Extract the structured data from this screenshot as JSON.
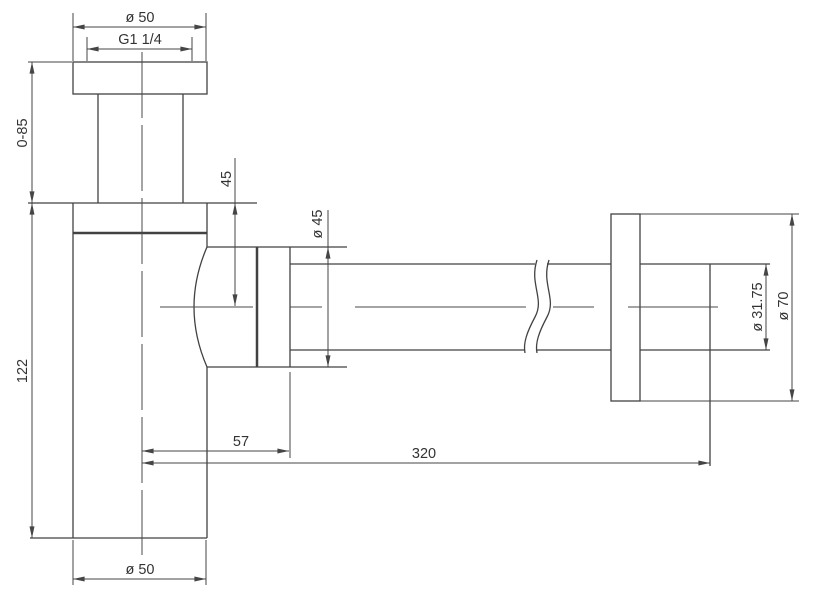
{
  "drawing": {
    "subject": "Bottle trap siphon dimensional drawing",
    "background": "#ffffff",
    "line_color": "#424242",
    "text_color": "#333333",
    "labels": {
      "inlet_flange_diameter": "ø 50",
      "thread_size": "G1 1/4",
      "adjustable_height": "0-85",
      "body_height": "122",
      "inlet_to_outlet_axis": "45",
      "nut_diameter": "ø 45",
      "cup_diameter": "ø 50",
      "axis_to_nut": "57",
      "axis_to_wall": "320",
      "outlet_pipe_diameter": "ø 31.75",
      "wall_flange_diameter": "ø 70"
    }
  }
}
